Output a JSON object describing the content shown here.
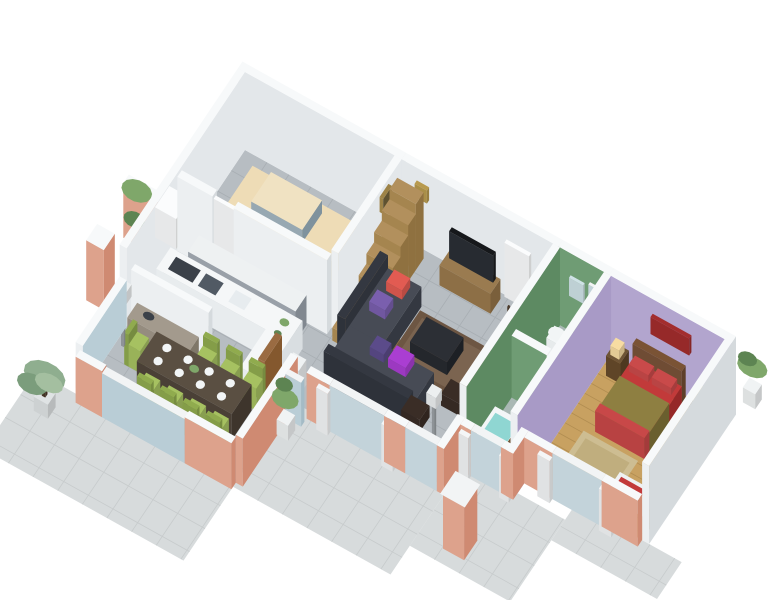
{
  "meta": {
    "description": "3D isometric cutaway floor plan render of a single-storey house",
    "background": "#ffffff",
    "projection": "isometric-render"
  },
  "scene": {
    "rooms": [
      {
        "id": "garage",
        "contents": [
          "beige-car"
        ]
      },
      {
        "id": "kitchen",
        "contents": [
          "white-counter",
          "cooktop",
          "sink",
          "gray-sideboard",
          "bar-chairs",
          "utility-appliance"
        ]
      },
      {
        "id": "dining-room",
        "contents": [
          "dark-wood-table",
          "green-chairs",
          "buffet",
          "floor-lamp",
          "place-settings"
        ]
      },
      {
        "id": "living-room",
        "contents": [
          "sectional-sofa",
          "throw-pillows",
          "coffee-table",
          "area-rug",
          "tv-on-pallet-stand",
          "wall-clock",
          "framed-picture",
          "wooden-winder-stairs",
          "back-door",
          "dry-plant",
          "poufs",
          "floor-lamp"
        ]
      },
      {
        "id": "bathroom",
        "contents": [
          "pedestal-sink",
          "mirror",
          "bathtub",
          "teal-stool",
          "maroon-rug",
          "wood-cabinet",
          "green-mosaic-walls"
        ]
      },
      {
        "id": "bedroom",
        "contents": [
          "double-bed-red",
          "headboard",
          "nightstands",
          "bedside-lamps",
          "red-wall-art",
          "beige-rug",
          "bench-with-clothes",
          "wood-floor"
        ]
      },
      {
        "id": "terrace",
        "contents": [
          "gray-tile-paving",
          "palm-plant",
          "potted-plants",
          "terracotta-pillar",
          "shuttered-windows",
          "sliding-glass-doors"
        ]
      }
    ]
  },
  "colors": {
    "wallTop": "#f7f9fa",
    "wallLight": "#eceff1",
    "wallInner": "#e3e7ea",
    "wallSide": "#d5dadd",
    "terraLight": "#dda28c",
    "terraMid": "#cf8a72",
    "bathGreen": "#5d8a62",
    "bathGreenLight": "#6f9c74",
    "purpleWall": "#b2a5ce",
    "purpleWallDeep": "#a89ac6",
    "floorTile": "#b7bdc2",
    "floorLine": "#a8aeb3",
    "patio": "#d7dbdc",
    "patioLine": "#c7cbcc",
    "bathFloor": "#a9b8b4",
    "bathFloorLine": "#97a6a2",
    "wood": "#c8a161",
    "woodLine": "#b18d51",
    "woodTop": "#b2905d",
    "woodLight": "#a5854f",
    "woodDark": "#8f7140",
    "tvWoodTop": "#9a7b50",
    "tvWoodFace": "#8d6f46",
    "tvWoodSide": "#7a5f3b",
    "carTop": "#eedcb6",
    "carLight": "#e5cd9f",
    "carDark": "#d9bd89",
    "carCabinTop": "#f0e2c2",
    "carGlass": "#97a8b2",
    "carGlassDark": "#7f929d",
    "doorWhite": "#fbfcfd",
    "clockGold": "#b89a4e",
    "pictureGold": "#9d8347",
    "pictureDark": "#5f5230",
    "sideTop": "#eef1f2",
    "sideFace": "#99a0a8",
    "sideDark": "#818890",
    "counterTop": "#f5f7f8",
    "counterFace": "#e8ecee",
    "counterSide": "#d9dee1",
    "cooktopDark": "#3b4149",
    "moduleDark": "#515a64",
    "sinkSteel": "#e7ecef",
    "chairWhite": "#eff2f3",
    "chairGreen": "#a6c161",
    "chairGreenDark": "#90ab4e",
    "buffTop": "#a39a8d",
    "buffFace": "#958c7f",
    "buffSide": "#7f7769",
    "tableTop": "#5a4f42",
    "tableFace": "#4a4036",
    "tableSide": "#3e352c",
    "plateWhite": "#f2f5f6",
    "doorWood": "#9a6b42",
    "doorWoodD": "#84582e",
    "lampPole": "#9aa0a4",
    "lampShade": "#eceff0",
    "lampGlow": "#f7dca2",
    "sofaTop": "#474b55",
    "sofaFace": "#3f434c",
    "sofaSide": "#343841",
    "sofaBackD": "#2e323a",
    "pillowCoral": "#e25b52",
    "pillowPurple": "#7a5fae",
    "pillowViolet": "#5b4b8a",
    "pillowMagenta": "#aa3ed2",
    "rugBrown": "#6d5643",
    "rugBrown2": "#7b6450",
    "ctTop": "#2c2f35",
    "ctFace": "#24272c",
    "ctSide": "#1d2025",
    "pouf": "#3a2d26",
    "potWhite": "#f0f3f4",
    "potGray": "#dfe3e4",
    "branch": "#4a3828",
    "plantGreen": "#7fa76a",
    "plantDark": "#5d8452",
    "palmGreen": "#8fae8f",
    "palmGreen2": "#7b9d7c",
    "palmGreen3": "#a4bfa0",
    "mirrorBlue": "#cfe2e6",
    "glass": "#b9cdd6",
    "glassDark": "#a4bbc6",
    "winGlass": "#c3d3da",
    "frameWhite": "#f2f4f5",
    "shutterWhite": "#f4f6f7",
    "tubTop": "#f3f6f7",
    "tubFace": "#e7ebec",
    "tubSide": "#d8dde0",
    "waterTeal": "#8fd6d2",
    "tealBold": "#35bcc2",
    "rugMaroon": "#6f2439",
    "cabTop": "#6e5435",
    "cabFace": "#5f4527",
    "cabSide": "#4e3820",
    "hbTop": "#7a5335",
    "hbFace": "#6f4c34",
    "hbSide": "#5e3f2a",
    "bedRedTop": "#c23a3a",
    "bedRedFace": "#ae3030",
    "bedRedSide": "#952828",
    "bedRed2": "#c84848",
    "oliveTop": "#8e7f41",
    "oliveFace": "#7d7037",
    "oliveSide": "#6a5f2e",
    "pillowBedRed": "#c94a4a",
    "rugBeige": "#cdbd92",
    "rugBeige2": "#c0ae7e",
    "benchWhite": "#eef1f2",
    "artRed": "#a32d2d",
    "tvDark": "#16181b",
    "tvScreen": "#272b31"
  }
}
